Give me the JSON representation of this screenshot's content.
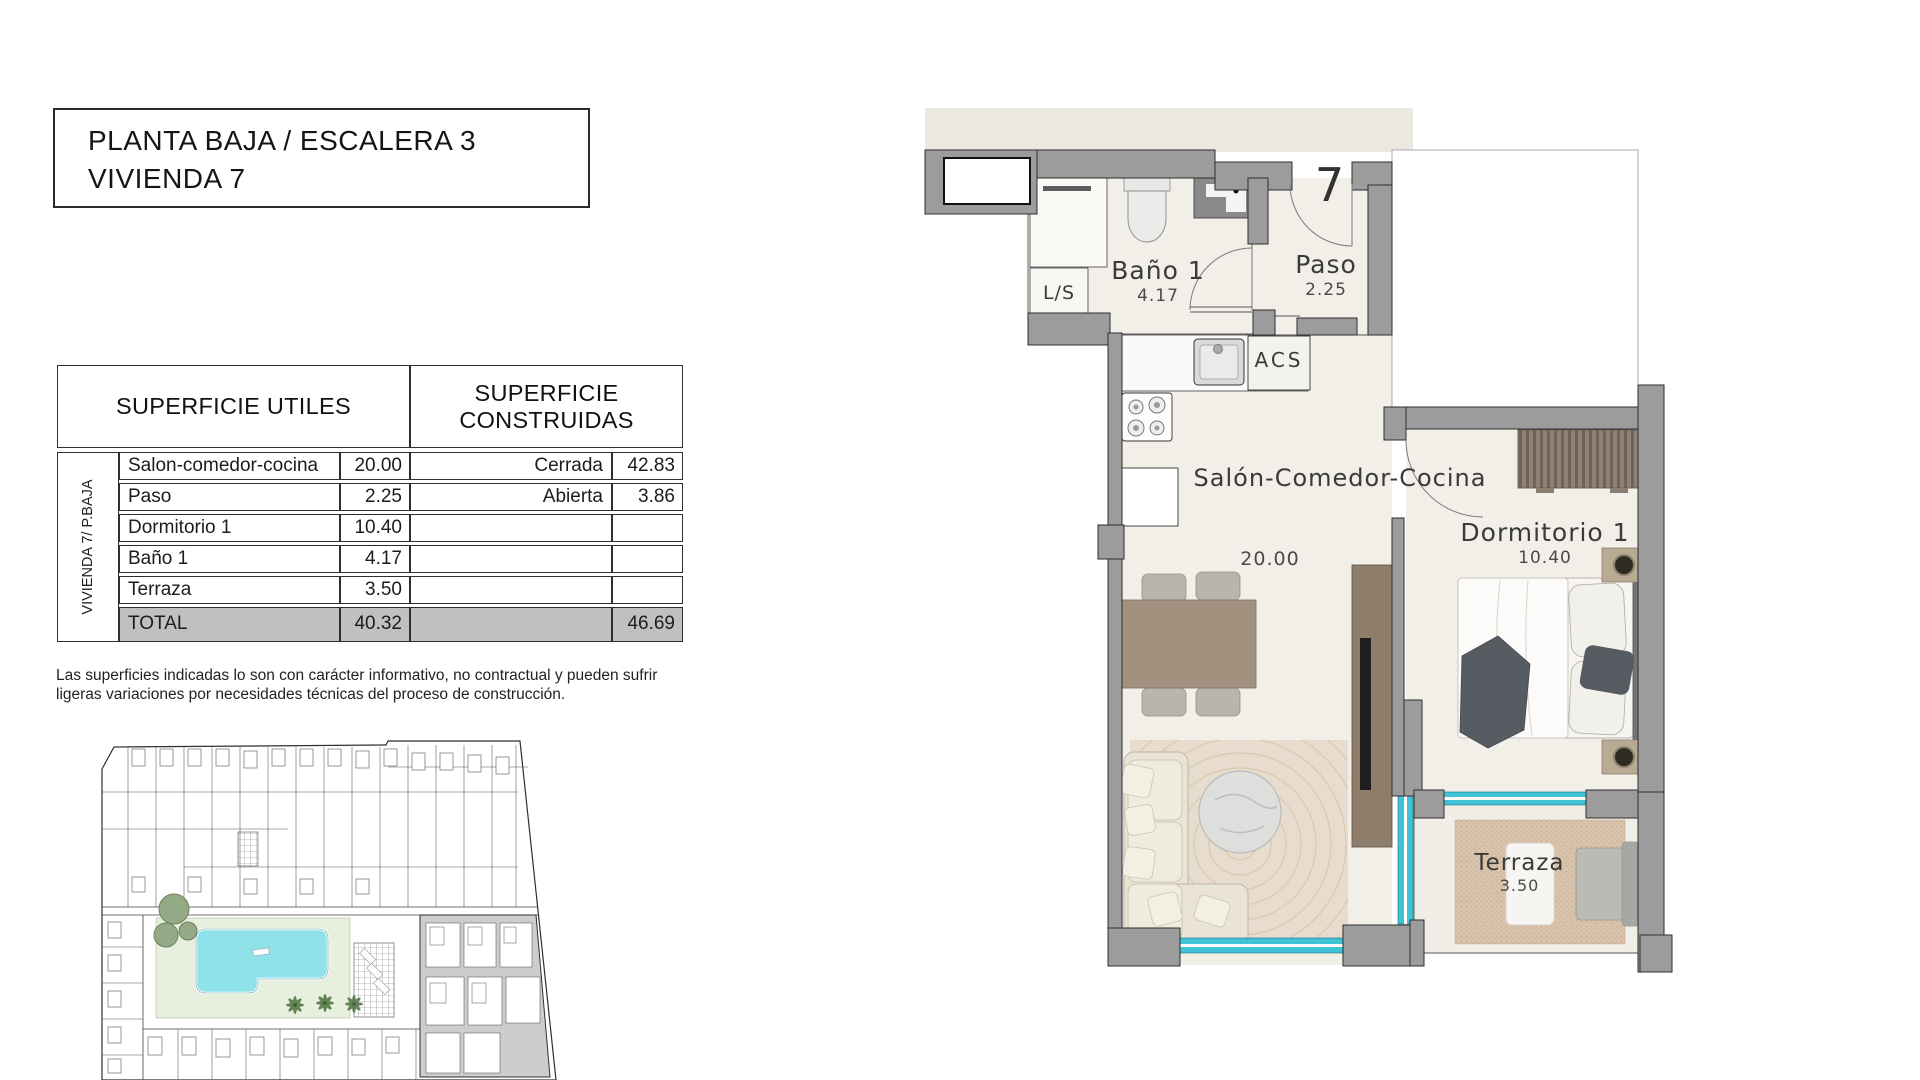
{
  "title_box": {
    "line1": "PLANTA BAJA / ESCALERA 3",
    "line2": "VIVIENDA 7"
  },
  "areas_table": {
    "header_left": "SUPERFICIE UTILES",
    "header_right": "SUPERFICIE CONSTRUIDAS",
    "row_group_label": "VIVIENDA 7/ P.BAJA",
    "rows": [
      {
        "name": "Salon-comedor-cocina",
        "value": "20.00",
        "right_name": "Cerrada",
        "right_value": "42.83"
      },
      {
        "name": "Paso",
        "value": "2.25",
        "right_name": "Abierta",
        "right_value": "3.86"
      },
      {
        "name": "Dormitorio 1",
        "value": "10.40",
        "right_name": "",
        "right_value": ""
      },
      {
        "name": "Baño 1",
        "value": "4.17",
        "right_name": "",
        "right_value": ""
      },
      {
        "name": "Terraza",
        "value": "3.50",
        "right_name": "",
        "right_value": ""
      }
    ],
    "total": {
      "label": "TOTAL",
      "value": "40.32",
      "right_value": "46.69"
    }
  },
  "disclaimer": {
    "line1": "Las superficies indicadas lo son con carácter informativo, no contractual y pueden sufrir",
    "line2": "ligeras variaciones por necesidades técnicas del proceso de construcción."
  },
  "floor_plan": {
    "unit_number": "7",
    "rooms": [
      {
        "name": "Baño 1",
        "area": "4.17"
      },
      {
        "name": "Paso",
        "area": "2.25"
      },
      {
        "name": "Salón-Comedor-Cocina",
        "area": "20.00"
      },
      {
        "name": "Dormitorio 1",
        "area": "10.40"
      },
      {
        "name": "Terraza",
        "area": "3.50"
      }
    ],
    "labels": {
      "laundry": "L/S",
      "water_heater": "ACS"
    }
  },
  "colors": {
    "wall_gray": "#9c9c9c",
    "window_cyan": "#3fc3d6",
    "total_row_gray": "#c0c0c0",
    "pool_cyan": "#8fe2ea",
    "floor_cream": "#f2efe8"
  }
}
